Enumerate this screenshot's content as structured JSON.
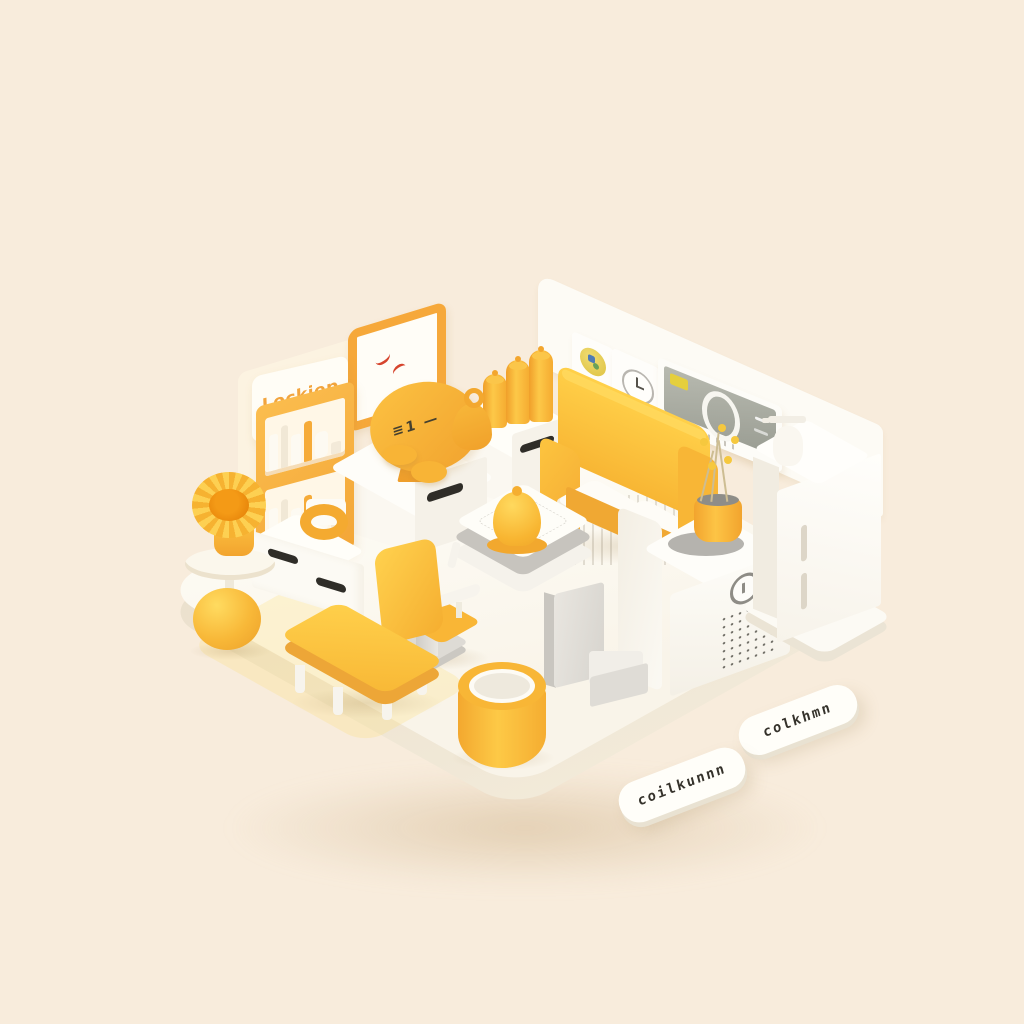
{
  "illustration": {
    "description": "isometric 3d room illustration in yellow, white and cream",
    "background_color": "#f8ecdc",
    "palette": {
      "yellow": "#fcc43e",
      "deep_yellow": "#f5ae30",
      "orange": "#ef9f2c",
      "white": "#fffefb",
      "cream_panel": "#fcf3e1",
      "gray": "#c9c6c0",
      "screen_gray": "#a0a399",
      "ink": "#35322b"
    },
    "texts": {
      "wall_sign": "Lockiep",
      "disc_marks": "≡1 —",
      "tag_upper_right": "colkhmn",
      "tag_lower_left": "coilkunnn"
    },
    "objects": [
      "wall-sign",
      "wall-clock",
      "bookshelf",
      "sideboard",
      "disc-mirror",
      "desk-cabinet",
      "cylinder-candles",
      "teardrop-ornament",
      "wall-plaques",
      "wall-control-panel",
      "sofa",
      "dried-flower-vase",
      "keypad-safe",
      "tall-cabinet",
      "soap-dispenser",
      "coffee-table",
      "bell",
      "office-chair",
      "low-table",
      "waste-bin",
      "step-stool",
      "side-table",
      "sunflower-pot",
      "sphere-vase",
      "ring-ornament",
      "name-tags"
    ]
  }
}
